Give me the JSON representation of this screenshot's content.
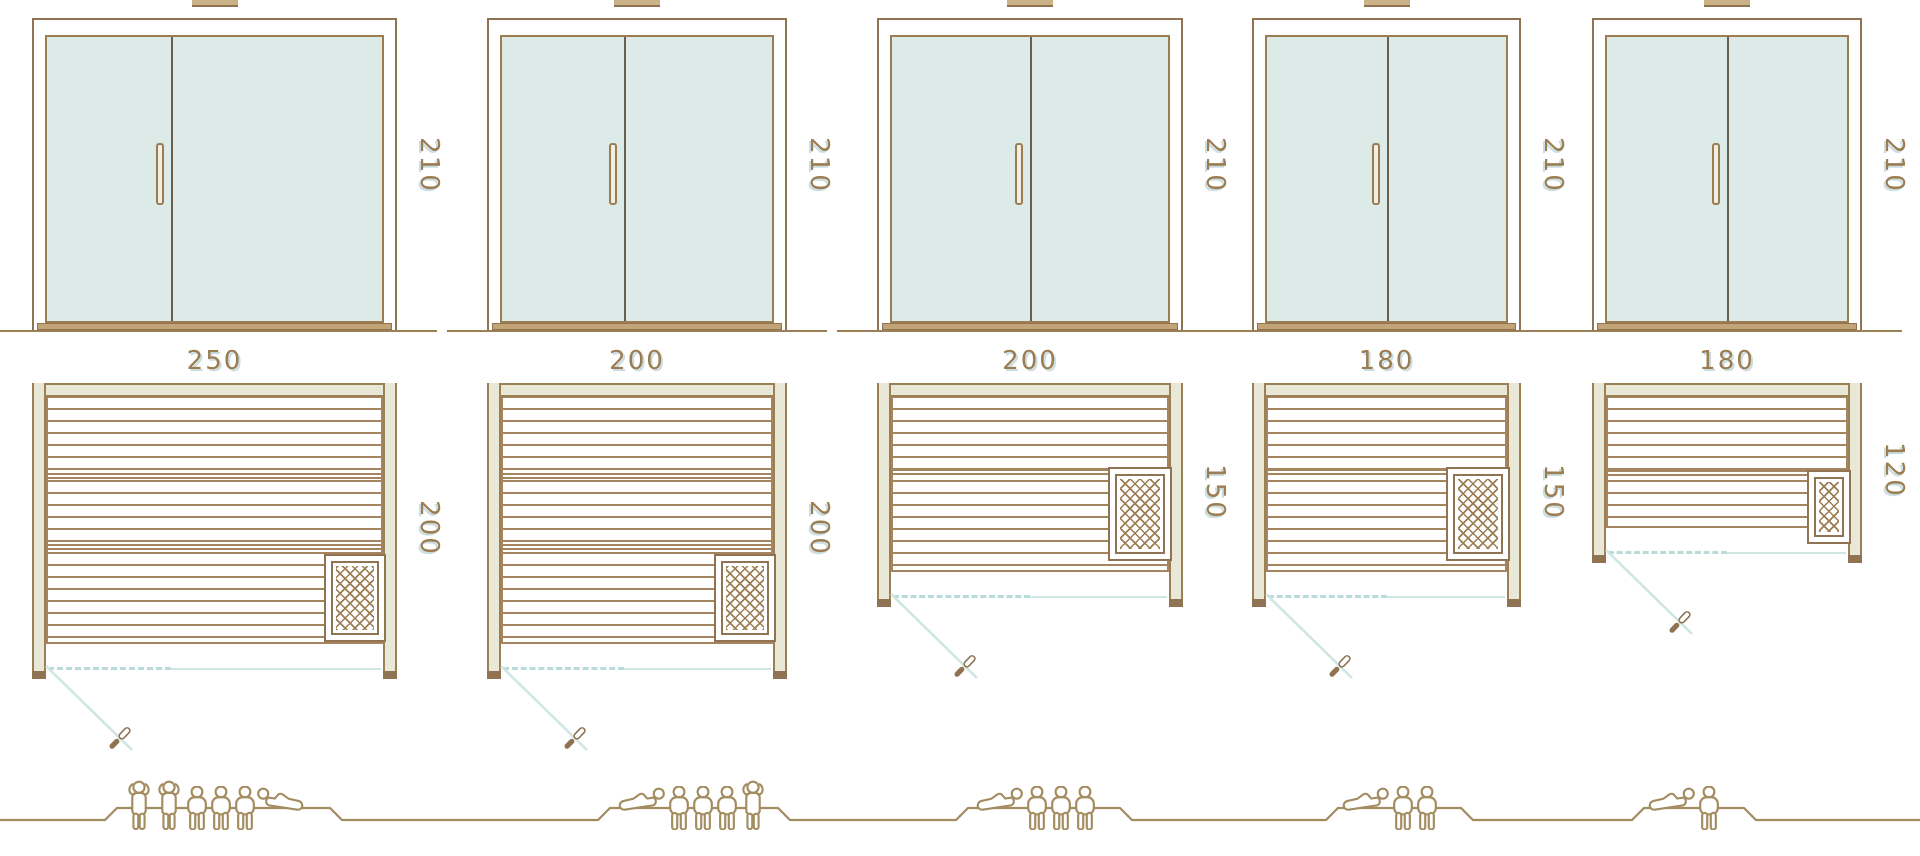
{
  "diagram": {
    "title": "sauna-size-comparison",
    "units": [
      {
        "name": "sauna-250x200",
        "width_label": "250",
        "depth_label": "200",
        "door_height_label": "210",
        "capacity": {
          "total": 6,
          "standing": 2,
          "sitting": 3,
          "lying": 1,
          "poses": [
            "stand",
            "stand",
            "sit",
            "sit",
            "sit",
            "lie-right"
          ]
        }
      },
      {
        "name": "sauna-200x200",
        "width_label": "200",
        "depth_label": "200",
        "door_height_label": "210",
        "capacity": {
          "total": 5,
          "standing": 1,
          "sitting": 3,
          "lying": 1,
          "poses": [
            "lie-left",
            "sit",
            "sit",
            "sit",
            "stand"
          ]
        }
      },
      {
        "name": "sauna-200x150",
        "width_label": "200",
        "depth_label": "150",
        "door_height_label": "210",
        "capacity": {
          "total": 4,
          "standing": 0,
          "sitting": 3,
          "lying": 1,
          "poses": [
            "lie-left",
            "sit",
            "sit",
            "sit"
          ]
        }
      },
      {
        "name": "sauna-180x150",
        "width_label": "180",
        "depth_label": "150",
        "door_height_label": "210",
        "capacity": {
          "total": 3,
          "standing": 0,
          "sitting": 2,
          "lying": 1,
          "poses": [
            "lie-left",
            "sit",
            "sit"
          ]
        }
      },
      {
        "name": "sauna-180x120",
        "width_label": "180",
        "depth_label": "120",
        "door_height_label": "210",
        "capacity": {
          "total": 2,
          "standing": 0,
          "sitting": 1,
          "lying": 1,
          "poses": [
            "lie-left",
            "sit"
          ]
        }
      }
    ],
    "icons": {
      "roof_vent": "vent-stub-icon",
      "heater": "sauna-heater-crosshatch-icon",
      "door_swing": "door-swing-leaf-icon",
      "person_standing": "person-standing-icon",
      "person_sitting": "person-sitting-icon",
      "person_lying": "person-lying-icon"
    },
    "colors": {
      "frame_brown": "#8f7352",
      "line_brown": "#a5855f",
      "wall_beige": "#e9e7d6",
      "glass_blue": "#dcebe7",
      "swing_blue": "#cfe6e2",
      "label_brown": "#9c7d52",
      "label_shadow_blue": "#c9dde2",
      "sill_tan": "#c2a477",
      "people_brown": "#a38c60"
    }
  }
}
